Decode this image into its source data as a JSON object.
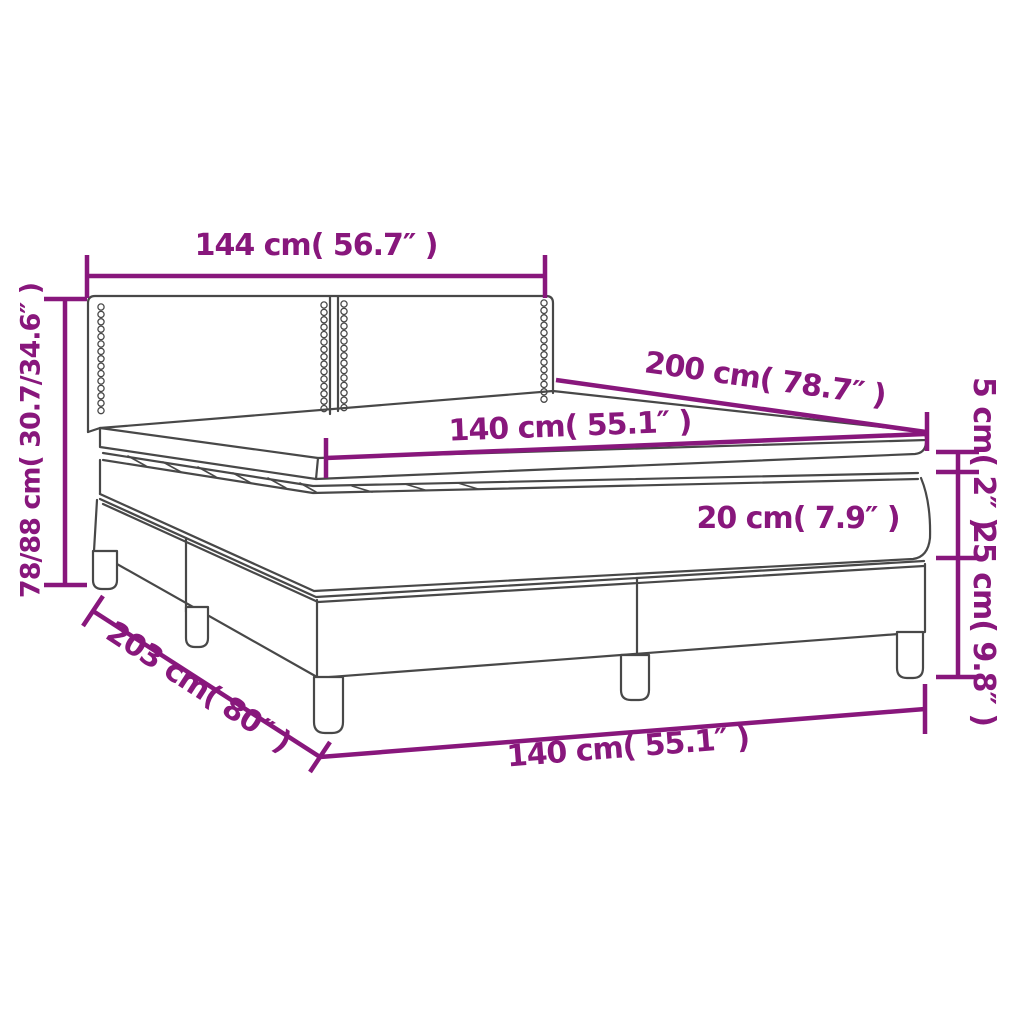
{
  "diagram": {
    "title": "Box spring bed dimension diagram",
    "accent_color": "#88177C",
    "outline_color": "#484848",
    "background_color": "#FFFFFF",
    "labels": {
      "headboard_width": "144 cm( 56.7″ )",
      "length_top": "200 cm( 78.7″ )",
      "width_top": "140 cm( 55.1″ )",
      "topper_height": "5 cm( 2″ )",
      "mattress_height": "20 cm( 7.9″ )",
      "base_height": "25 cm( 9.8″ )",
      "overall_height": "78/88 cm( 30.7/34.6″ )",
      "length_bottom": "203 cm( 80″ )",
      "width_bottom": "140 cm( 55.1″ )"
    }
  }
}
